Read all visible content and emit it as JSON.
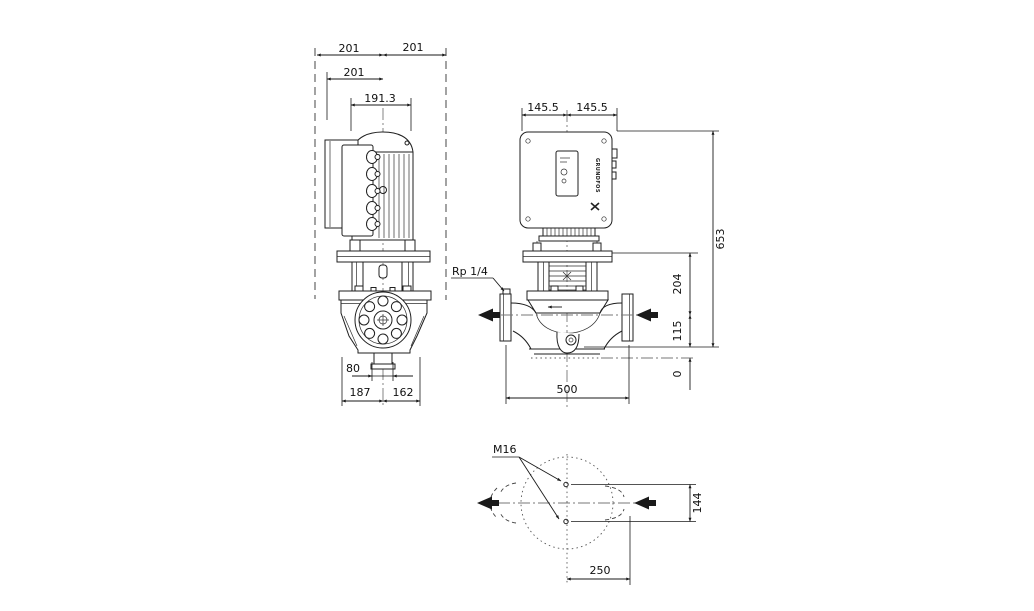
{
  "front_view": {
    "dim_total_left": "201",
    "dim_total_right": "201",
    "dim_terminal_box": "201",
    "dim_motor_width": "191.3",
    "dim_drain_port": "80",
    "dim_base_left": "187",
    "dim_base_right": "162"
  },
  "side_view": {
    "dim_half_left": "145.5",
    "dim_half_right": "145.5",
    "port_label": "Rp 1/4",
    "dim_base_width": "500",
    "dim_total_height": "653",
    "dim_flange_to_port": "204",
    "dim_port_to_base": "115",
    "dim_datum": "0"
  },
  "bottom_view": {
    "bolt_label": "M16",
    "dim_bolt_span": "144",
    "dim_offset": "250"
  },
  "brand": {
    "logotype": "GRUNDFOS"
  }
}
